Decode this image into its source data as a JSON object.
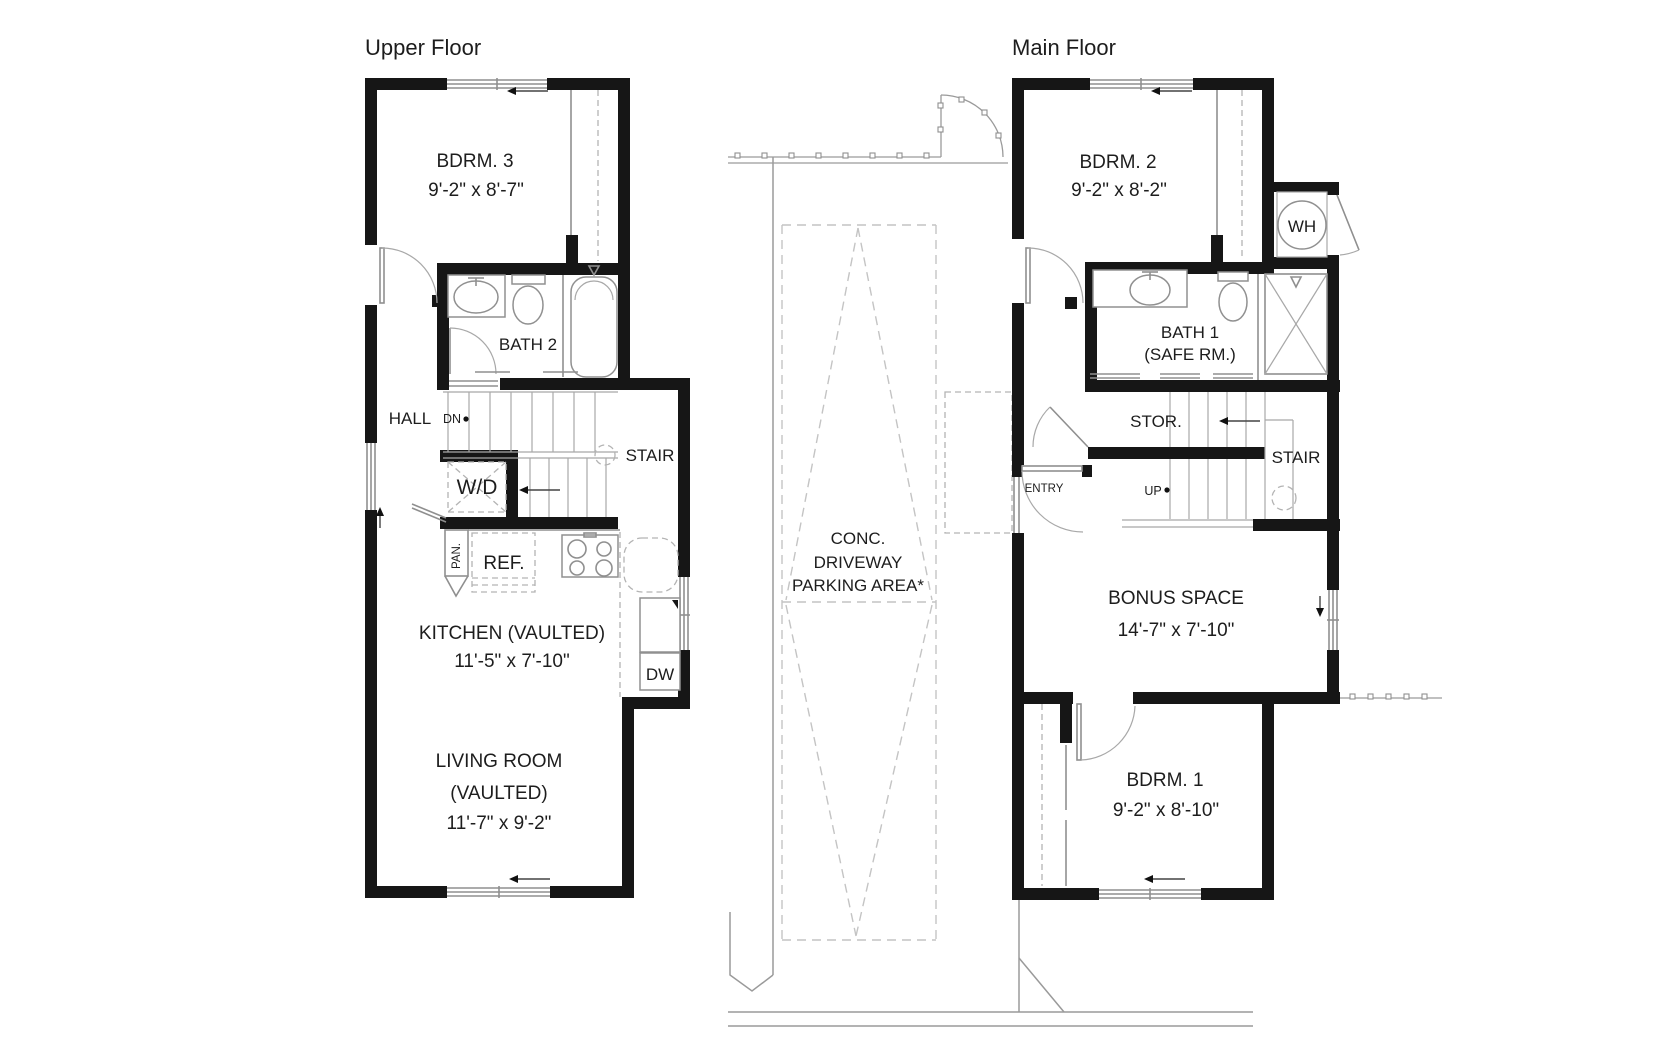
{
  "upper": {
    "title": "Upper Floor",
    "bdrm3": "BDRM. 3",
    "bdrm3_dims": "9'-2\" x 8'-7\"",
    "bath2": "BATH 2",
    "hall": "HALL",
    "dn": "DN",
    "stair": "STAIR",
    "wd": "W/D",
    "pan": "PAN.",
    "ref": "REF.",
    "kitchen": "KITCHEN (VAULTED)",
    "kitchen_dims": "11'-5\" x 7'-10\"",
    "dw": "DW",
    "living1": "LIVING ROOM",
    "living2": "(VAULTED)",
    "living_dims": "11'-7\" x 9'-2\""
  },
  "site": {
    "conc": "CONC.",
    "driveway": "DRIVEWAY",
    "parking": "PARKING AREA*"
  },
  "main": {
    "title": "Main Floor",
    "bdrm2": "BDRM. 2",
    "bdrm2_dims": "9'-2\" x 8'-2\"",
    "wh": "WH",
    "bath1": "BATH 1",
    "bath1_safe": "(SAFE RM.)",
    "stor": "STOR.",
    "stair": "STAIR",
    "up": "UP",
    "entry": "ENTRY",
    "bonus": "BONUS SPACE",
    "bonus_dims": "14'-7\" x 7'-10\"",
    "bdrm1": "BDRM. 1",
    "bdrm1_dims": "9'-2\" x 8'-10\""
  },
  "colors": {
    "wall": "#161616",
    "thin_line": "#8f8f8f",
    "dashed_line": "#c4c4c4",
    "text": "#1d1d1d",
    "background": "#ffffff"
  }
}
